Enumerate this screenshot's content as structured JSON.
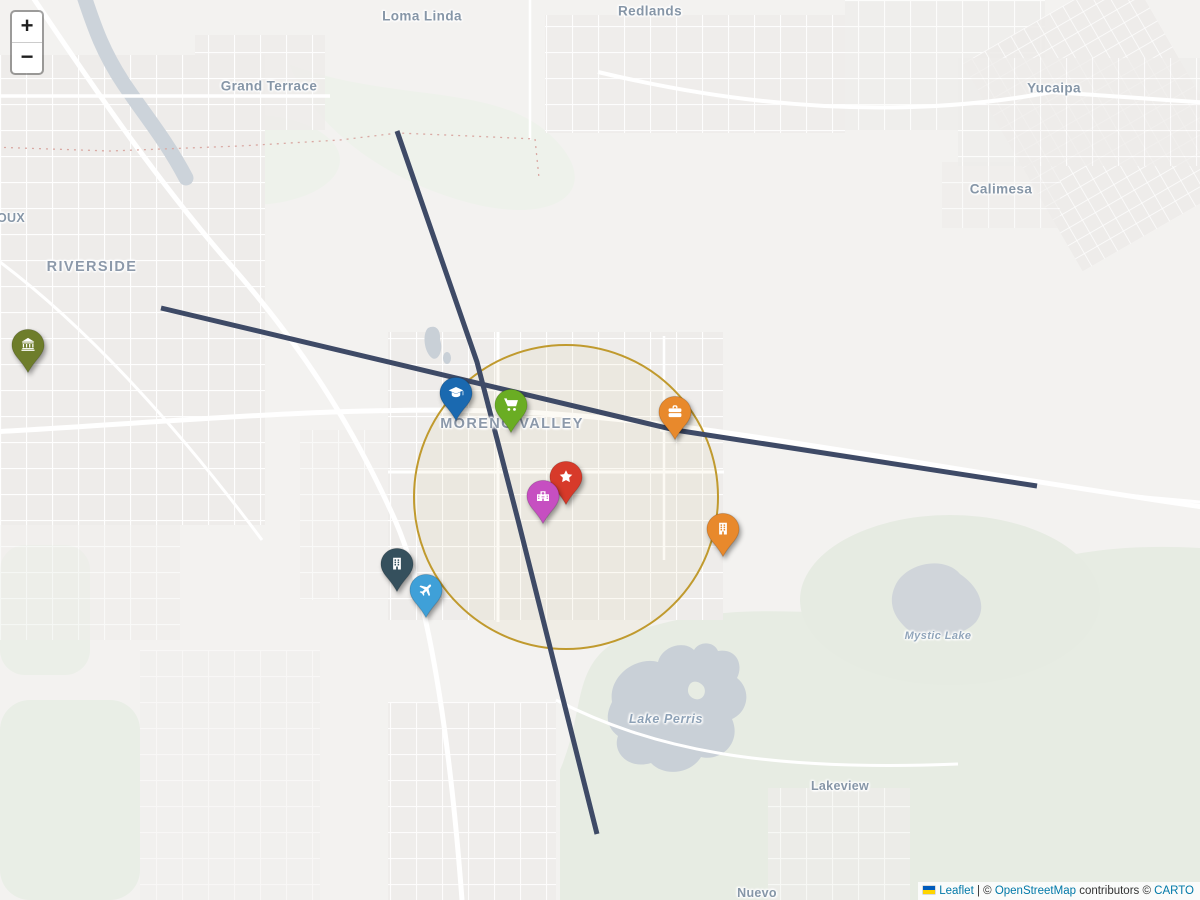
{
  "map": {
    "zoom_control": {
      "zoom_in": "+",
      "zoom_out": "−"
    },
    "attribution": {
      "flag": "ukraine-flag",
      "leaflet": "Leaflet",
      "sep1": " | © ",
      "osm": "OpenStreetMap",
      "sep2": " contributors © ",
      "carto": "CARTO"
    }
  },
  "labels": [
    {
      "id": "loma-linda",
      "text": "Loma Linda",
      "x": 422,
      "y": 16,
      "cls": "town"
    },
    {
      "id": "redlands",
      "text": "Redlands",
      "x": 650,
      "y": 11,
      "cls": "town"
    },
    {
      "id": "grand-terrace",
      "text": "Grand Terrace",
      "x": 269,
      "y": 86,
      "cls": "town"
    },
    {
      "id": "yucaipa",
      "text": "Yucaipa",
      "x": 1054,
      "y": 88,
      "cls": "town"
    },
    {
      "id": "calimesa",
      "text": "Calimesa",
      "x": 1001,
      "y": 189,
      "cls": "town"
    },
    {
      "id": "rubidoux",
      "text": "OUX",
      "x": 11,
      "y": 218,
      "cls": "town-sm"
    },
    {
      "id": "riverside",
      "text": "RIVERSIDE",
      "x": 92,
      "y": 267,
      "cls": "city"
    },
    {
      "id": "moreno-valley",
      "text": "MORENO VALLEY",
      "x": 512,
      "y": 424,
      "cls": "city"
    },
    {
      "id": "mystic-lake",
      "text": "Mystic Lake",
      "x": 938,
      "y": 636,
      "cls": "water-sm"
    },
    {
      "id": "lake-perris",
      "text": "Lake Perris",
      "x": 666,
      "y": 719,
      "cls": "water"
    },
    {
      "id": "lakeview",
      "text": "Lakeview",
      "x": 840,
      "y": 786,
      "cls": "town-sm"
    },
    {
      "id": "nuevo",
      "text": "Nuevo",
      "x": 757,
      "y": 893,
      "cls": "town-sm"
    }
  ],
  "markers": [
    {
      "name": "bank-marker",
      "icon": "landmark",
      "color": "#6e7d2b",
      "tip_x": 28,
      "tip_y": 373
    },
    {
      "name": "university-marker",
      "icon": "graduation-cap",
      "color": "#1a69b0",
      "tip_x": 456,
      "tip_y": 421
    },
    {
      "name": "grocery-marker",
      "icon": "shopping-cart",
      "color": "#6aad23",
      "tip_x": 511,
      "tip_y": 433
    },
    {
      "name": "business-marker",
      "icon": "briefcase",
      "color": "#e8892c",
      "tip_x": 675,
      "tip_y": 440
    },
    {
      "name": "attraction-marker",
      "icon": "star",
      "color": "#d73a2a",
      "tip_x": 566,
      "tip_y": 505
    },
    {
      "name": "hospital-marker",
      "icon": "hospital",
      "color": "#c64fc1",
      "tip_x": 543,
      "tip_y": 524
    },
    {
      "name": "office-marker",
      "icon": "building",
      "color": "#35505d",
      "tip_x": 397,
      "tip_y": 592
    },
    {
      "name": "airport-marker",
      "icon": "plane",
      "color": "#3fa0d8",
      "tip_x": 426,
      "tip_y": 618
    },
    {
      "name": "company-marker",
      "icon": "building",
      "color": "#e8892c",
      "tip_x": 723,
      "tip_y": 557
    }
  ],
  "overlays": {
    "circle": {
      "name": "radius-circle",
      "cx": 566,
      "cy": 497,
      "r": 152,
      "stroke": "#c09a2e",
      "stroke_width": 2,
      "fill": "rgba(192,154,46,0.05)"
    },
    "lines": [
      {
        "name": "route-line-north-south",
        "color": "#3e4a66",
        "width": 5,
        "points": [
          [
            397,
            131
          ],
          [
            477,
            362
          ],
          [
            518,
            520
          ],
          [
            597,
            834
          ]
        ]
      },
      {
        "name": "route-line-east-west",
        "color": "#3e4a66",
        "width": 5,
        "points": [
          [
            161,
            308
          ],
          [
            675,
            430
          ],
          [
            1037,
            486
          ]
        ]
      }
    ]
  }
}
